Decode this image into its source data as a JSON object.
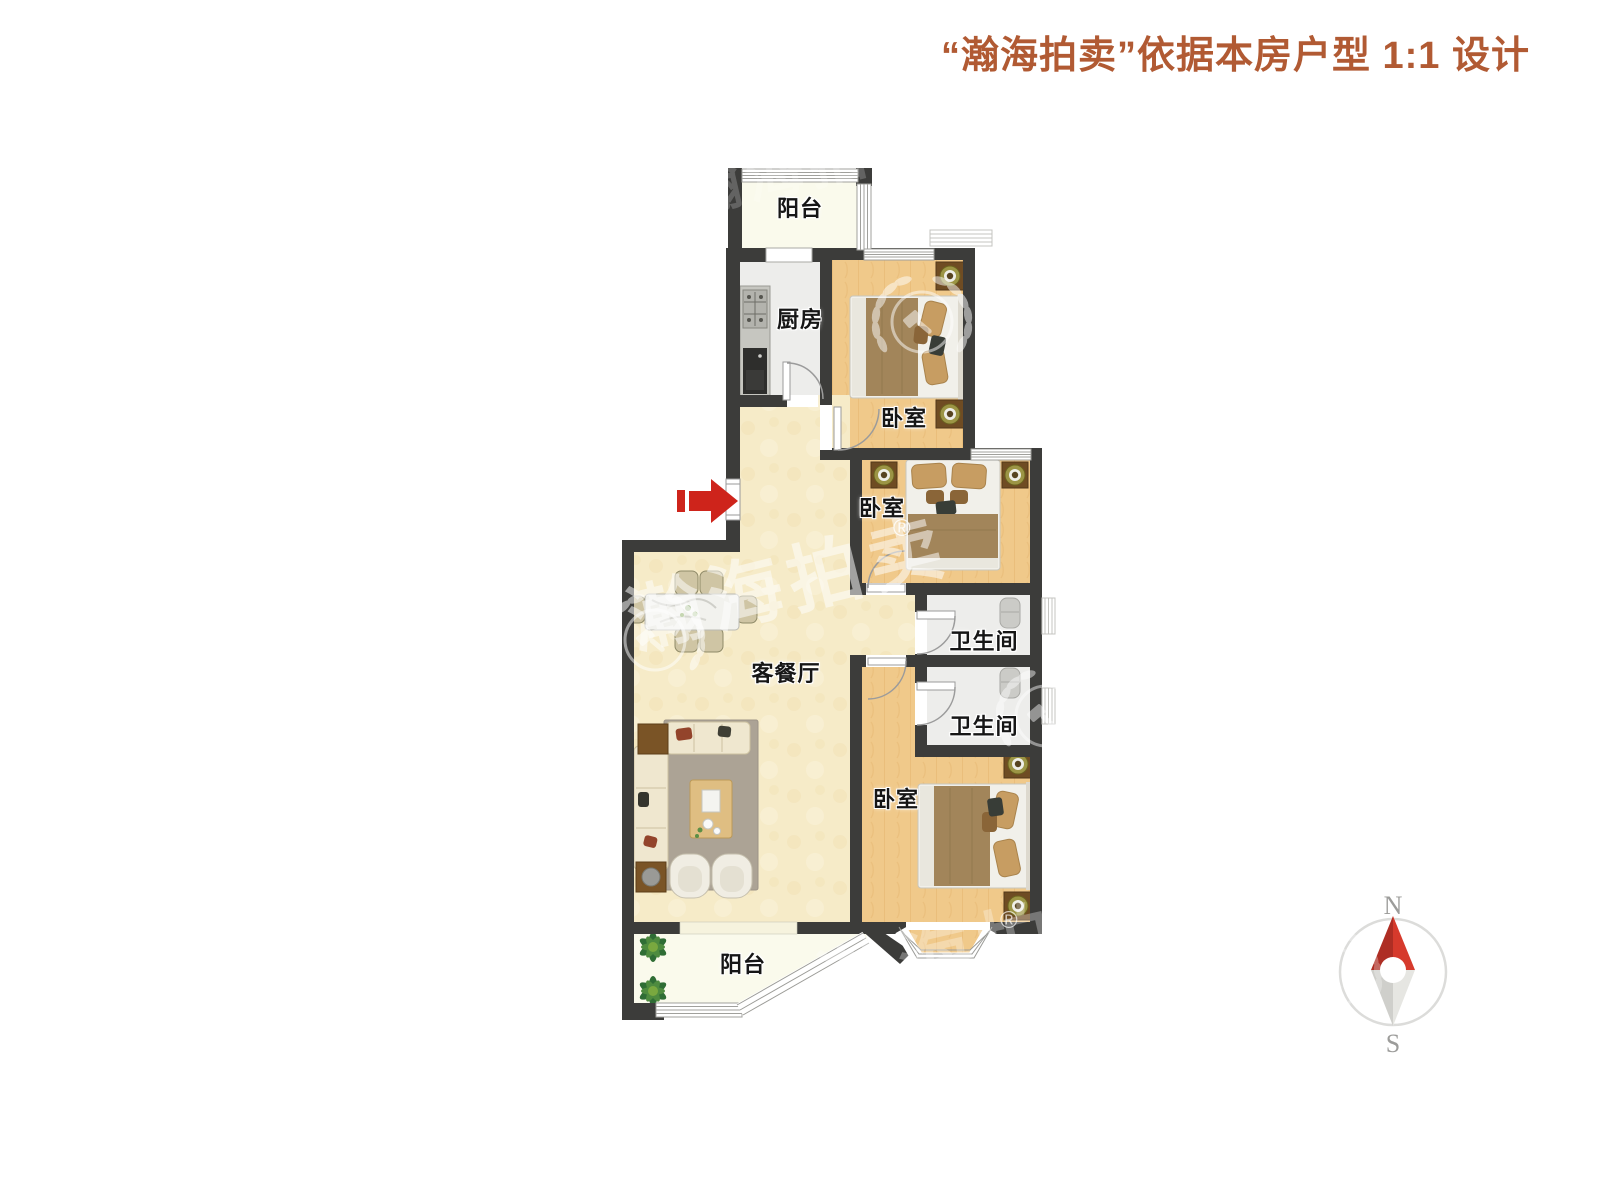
{
  "title": {
    "text": "“瀚海拍卖”依据本房户型 1:1 设计"
  },
  "rooms": {
    "balcony_top": {
      "label": "阳台"
    },
    "kitchen": {
      "label": "厨房"
    },
    "bedroom_top": {
      "label": "卧室"
    },
    "bedroom_middle": {
      "label": "卧室"
    },
    "bathroom_upper": {
      "label": "卫生间"
    },
    "bathroom_lower": {
      "label": "卫生间"
    },
    "living_dining": {
      "label": "客餐厅"
    },
    "bedroom_bottom": {
      "label": "卧室"
    },
    "balcony_bottom": {
      "label": "阳台"
    }
  },
  "compass": {
    "north_label": "N",
    "south_label": "S"
  },
  "watermark": {
    "brand_text": "瀚海拍卖",
    "registered_mark": "®"
  },
  "colors": {
    "title": "#B15A33",
    "wall": "#3C3C3A",
    "arrow_red": "#CE241B",
    "wood_floor": "#F0C98A",
    "cream_floor": "#F6EBC8",
    "gray_floor": "#EDEDEB",
    "balcony_floor": "#FAFAEC"
  }
}
